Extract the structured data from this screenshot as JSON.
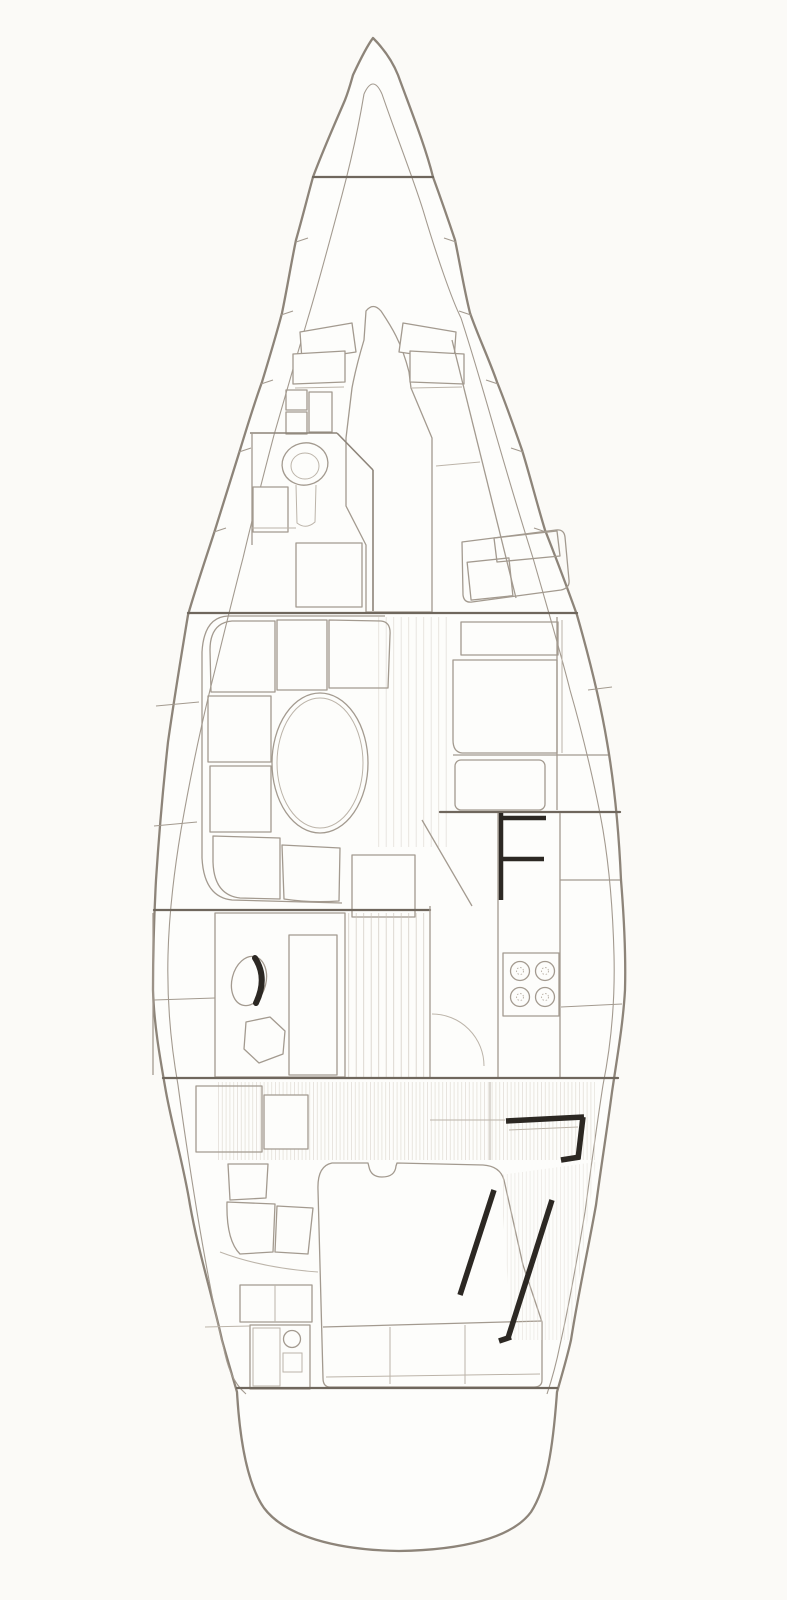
{
  "diagram": {
    "type": "technical-drawing",
    "subject": "sailboat-interior-accommodation-plan-top-view",
    "text_labels": []
  },
  "palette": {
    "paper": "#fbfaf7",
    "fill": "#fdfdfb",
    "ink": "#8d8479",
    "ink2": "#a39a8f",
    "ink3": "#bcb4a9",
    "dark": "#6f675d",
    "bold": "#2c2823",
    "tex": "#c9c2b8",
    "tex2": "#d9d3ca",
    "dot": "#a9a196"
  },
  "components": [
    "hull-outline",
    "hull-liner",
    "chain-locker-bulkhead",
    "v-berth-cushions",
    "forward-cabin-sole",
    "forward-head",
    "toilet",
    "shower-grating",
    "starboard-berth",
    "starboard-seat",
    "saloon-settee",
    "saloon-table",
    "centerline-grating",
    "nav-station",
    "chart-table",
    "nav-seat",
    "galley-port-counter",
    "galley-sink",
    "galley-drainboard",
    "galley-starboard-counter",
    "stove",
    "companionway-steps",
    "engine-hatch-area",
    "aft-cabin-double-berth",
    "aft-cabin-seats",
    "aft-cabin-vanity",
    "aft-bulkhead",
    "transom"
  ]
}
